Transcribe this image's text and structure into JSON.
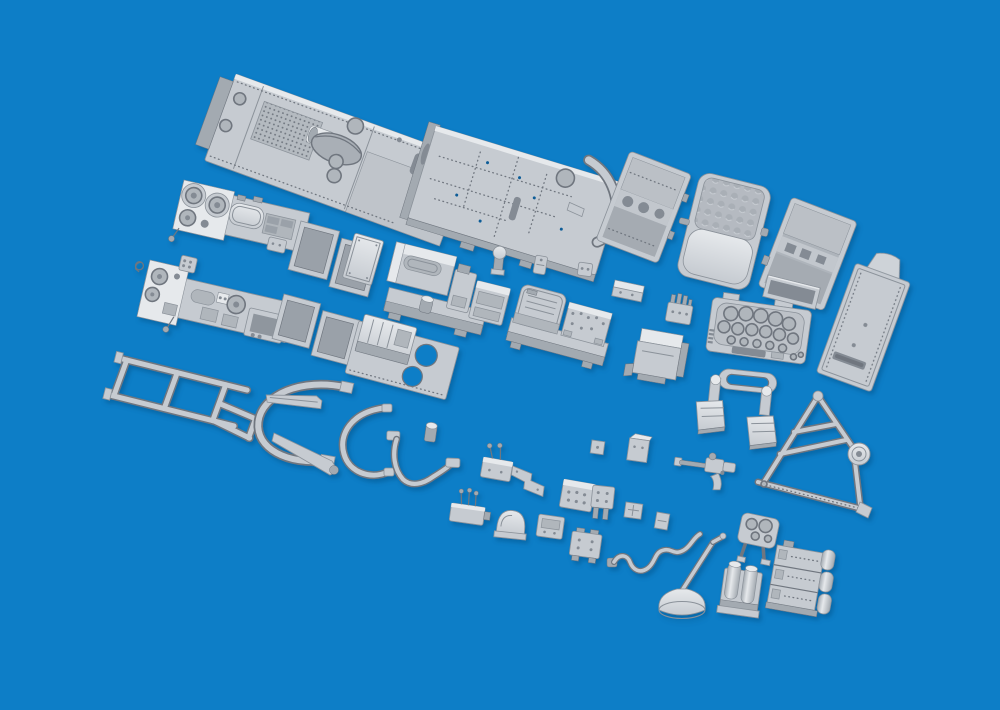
{
  "scene": {
    "description": "Product render of a grey resin scale-model aircraft cockpit detail set: floor panels, seats, side consoles, instrument panel, radio boxes, frames, tubing and many small fittings arranged diagonally on a blue background",
    "colors": {
      "bg": "#0d7ec7",
      "part": "#c6cbd1",
      "hl": "#e6e9ec",
      "side": "#a3aab1",
      "recess": "#b0b6bc",
      "deep": "#848b94",
      "edge": "#8b929a",
      "edge2": "#6f767f",
      "shadow": "#0a4d84"
    }
  },
  "parts": [
    {
      "id": "p01",
      "name": "cockpit-floor-forward",
      "label": "forward cockpit floor panel with perforated mat and seat cut-out",
      "x": 236,
      "y": 74,
      "r": 20
    },
    {
      "id": "p02",
      "name": "cockpit-floor-rear",
      "label": "rear cockpit floor panel with rivet rows and curved former",
      "x": 436,
      "y": 126,
      "r": 17
    },
    {
      "id": "p03",
      "name": "seat-bucket-left",
      "label": "bucket seat shell",
      "x": 630,
      "y": 151,
      "r": 21
    },
    {
      "id": "p04",
      "name": "seat-cushioned",
      "label": "seat with quilted back cushion",
      "x": 701,
      "y": 171,
      "r": 14
    },
    {
      "id": "p05",
      "name": "seat-bucket-right",
      "label": "second bucket seat shell",
      "x": 792,
      "y": 197,
      "r": 21
    },
    {
      "id": "p06",
      "name": "armor-back-plate",
      "label": "seat back armor plate with headrest",
      "x": 856,
      "y": 263,
      "r": 20
    },
    {
      "id": "p07",
      "name": "console-strip-upper",
      "label": "port sidewall console with gauges",
      "x": 184,
      "y": 180,
      "r": 13
    },
    {
      "id": "p08",
      "name": "frame-trays-upper",
      "label": "pair of open equipment trays",
      "x": 301,
      "y": 221,
      "r": 15
    },
    {
      "id": "p09",
      "name": "console-strip-lower",
      "label": "starboard sidewall console with instruments",
      "x": 150,
      "y": 260,
      "r": 13
    },
    {
      "id": "p10",
      "name": "frame-trays-lower",
      "label": "second pair of open equipment trays",
      "x": 284,
      "y": 294,
      "r": 15
    },
    {
      "id": "p11",
      "name": "ladder-frame",
      "label": "open support frame",
      "x": 120,
      "y": 346,
      "r": 14
    },
    {
      "id": "p12",
      "name": "horseshoe-frame",
      "label": "curved canopy hoop",
      "x": 254,
      "y": 376,
      "r": 2
    },
    {
      "id": "p13",
      "name": "arc-frame-small",
      "label": "small curved frame",
      "x": 336,
      "y": 404,
      "r": 0
    },
    {
      "id": "p14",
      "name": "tapered-arm-upper",
      "label": "tapered rail",
      "x": 267,
      "y": 389,
      "r": 8
    },
    {
      "id": "p15",
      "name": "tapered-arm-lower",
      "label": "tapered rail long",
      "x": 274,
      "y": 431,
      "r": 0
    },
    {
      "id": "p16",
      "name": "y-tube",
      "label": "bent linkage tube",
      "x": 389,
      "y": 429,
      "r": 2
    },
    {
      "id": "p17",
      "name": "small-canister",
      "label": "small canister",
      "x": 427,
      "y": 420,
      "r": 8
    },
    {
      "id": "p18",
      "name": "battery-tray",
      "label": "battery box on tray with two holes",
      "x": 361,
      "y": 313,
      "r": 15
    },
    {
      "id": "p19",
      "name": "flat-plate",
      "label": "flat access plate",
      "x": 355,
      "y": 233,
      "r": 16
    },
    {
      "id": "p20",
      "name": "equipment-shelf",
      "label": "equipment shelf with boxes",
      "x": 398,
      "y": 236,
      "r": 14
    },
    {
      "id": "p21",
      "name": "indicator-lamp",
      "label": "lamp fitting",
      "x": 494,
      "y": 244,
      "r": 6
    },
    {
      "id": "p22",
      "name": "tiny-box-a",
      "label": "small fitting",
      "x": 536,
      "y": 255,
      "r": 10
    },
    {
      "id": "p23",
      "name": "tiny-box-b",
      "label": "small fitting",
      "x": 579,
      "y": 262,
      "r": 8
    },
    {
      "id": "p24",
      "name": "radio-rack",
      "label": "radio set on mounting tray",
      "x": 521,
      "y": 283,
      "r": 15
    },
    {
      "id": "p25",
      "name": "shelf-small",
      "label": "small shelf",
      "x": 615,
      "y": 280,
      "r": 12
    },
    {
      "id": "p26",
      "name": "connector-pins",
      "label": "connector block with pins",
      "x": 670,
      "y": 293,
      "r": 10
    },
    {
      "id": "p27",
      "name": "equipment-box",
      "label": "equipment box with flange",
      "x": 640,
      "y": 328,
      "r": 10
    },
    {
      "id": "p28",
      "name": "instrument-panel",
      "label": "main instrument panel with dial recesses",
      "x": 713,
      "y": 297,
      "r": 8
    },
    {
      "id": "p29",
      "name": "stowage-tray",
      "label": "shallow stowage tray",
      "x": 768,
      "y": 275,
      "r": 14
    },
    {
      "id": "p30",
      "name": "rudder-pedals",
      "label": "rudder pedal assembly",
      "x": 700,
      "y": 366,
      "r": 6
    },
    {
      "id": "p31",
      "name": "a-frame-truss",
      "label": "A-frame truss with pulley wheel",
      "x": 756,
      "y": 390,
      "r": 0
    },
    {
      "id": "p32",
      "name": "flexible-drive",
      "label": "gun-shaped flexible drive",
      "x": 682,
      "y": 444,
      "r": 8
    },
    {
      "id": "p33",
      "name": "lever-quadrant-a",
      "label": "lever quadrant",
      "x": 485,
      "y": 449,
      "r": 10
    },
    {
      "id": "p34",
      "name": "angle-bracket",
      "label": "stepped bracket",
      "x": 513,
      "y": 464,
      "r": 8
    },
    {
      "id": "p35",
      "name": "stud-box",
      "label": "detail box with studs",
      "x": 564,
      "y": 479,
      "r": 10
    },
    {
      "id": "p36",
      "name": "tall-box",
      "label": "small tall box",
      "x": 630,
      "y": 436,
      "r": 8
    },
    {
      "id": "p37",
      "name": "tiny-box-c",
      "label": "small fitting",
      "x": 592,
      "y": 440,
      "r": 8
    },
    {
      "id": "p38",
      "name": "connector-legs",
      "label": "connector with legs",
      "x": 593,
      "y": 485,
      "r": 6
    },
    {
      "id": "p39",
      "name": "small-plate",
      "label": "small plate",
      "x": 626,
      "y": 502,
      "r": 8
    },
    {
      "id": "p40",
      "name": "tiny-box-d",
      "label": "small fitting",
      "x": 657,
      "y": 512,
      "r": 10
    },
    {
      "id": "p41",
      "name": "lever-quadrant-b",
      "label": "lever quadrant with levers",
      "x": 453,
      "y": 493,
      "r": 8
    },
    {
      "id": "p42",
      "name": "dome-fairing",
      "label": "dome fairing",
      "x": 498,
      "y": 506,
      "r": 6
    },
    {
      "id": "p43",
      "name": "detail-box-b",
      "label": "detail box",
      "x": 539,
      "y": 514,
      "r": 8
    },
    {
      "id": "p44",
      "name": "detail-box-c",
      "label": "detail box with feet",
      "x": 573,
      "y": 527,
      "r": 8
    },
    {
      "id": "p45",
      "name": "oxygen-hose",
      "label": "wavy oxygen hose",
      "x": 610,
      "y": 514,
      "r": 0
    },
    {
      "id": "p46",
      "name": "control-stick",
      "label": "control stick with bell boot",
      "x": 655,
      "y": 548,
      "r": 0
    },
    {
      "id": "p47",
      "name": "compass-panel",
      "label": "small dial panel with legs",
      "x": 743,
      "y": 512,
      "r": 12
    },
    {
      "id": "p48",
      "name": "twin-cylinder-box",
      "label": "twin cylinder bottle box",
      "x": 726,
      "y": 560,
      "r": 8
    },
    {
      "id": "p49",
      "name": "ammo-box-stack",
      "label": "stacked ammunition boxes",
      "x": 778,
      "y": 541,
      "r": 10
    }
  ]
}
